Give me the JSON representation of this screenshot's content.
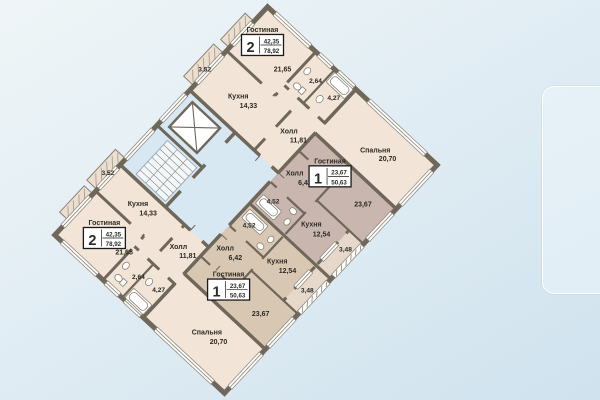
{
  "plan": {
    "rooms": {
      "kitchen_large": {
        "name": "Кухня",
        "area": "14,33"
      },
      "kitchen_small": {
        "name": "Кухня",
        "area": "12,54"
      },
      "hall_large": {
        "name": "Холл",
        "area": "11,81"
      },
      "hall_small": {
        "name": "Холл",
        "area": "6,42"
      },
      "bedroom": {
        "name": "Спальня",
        "area": "20,70"
      },
      "living_large_area": "21,65",
      "living_small_area": "23,67",
      "wc_area": "2,64",
      "bath_large_area": "4,27",
      "bath_small_area": "4,52",
      "balcony_large_area": "3,52",
      "balcony_small_area": "3,48"
    },
    "apartments": {
      "two_room": {
        "room_label": "Гостиная",
        "rooms_count": "2",
        "living_area": "42,35",
        "total_area": "78,92"
      },
      "one_room": {
        "room_label": "Гостиная",
        "rooms_count": "1",
        "living_area": "23,67",
        "total_area": "50,63"
      }
    },
    "colors": {
      "wall": "#6f675a",
      "apartment_two_room": "#f2e4d6",
      "apartment_one_room_right": "#c8b6af",
      "apartment_one_room_left": "#d8c7b3",
      "common_core": "#d7e8f2",
      "background_top": "#eff5f7",
      "background_bottom": "#cfe2ee"
    }
  }
}
